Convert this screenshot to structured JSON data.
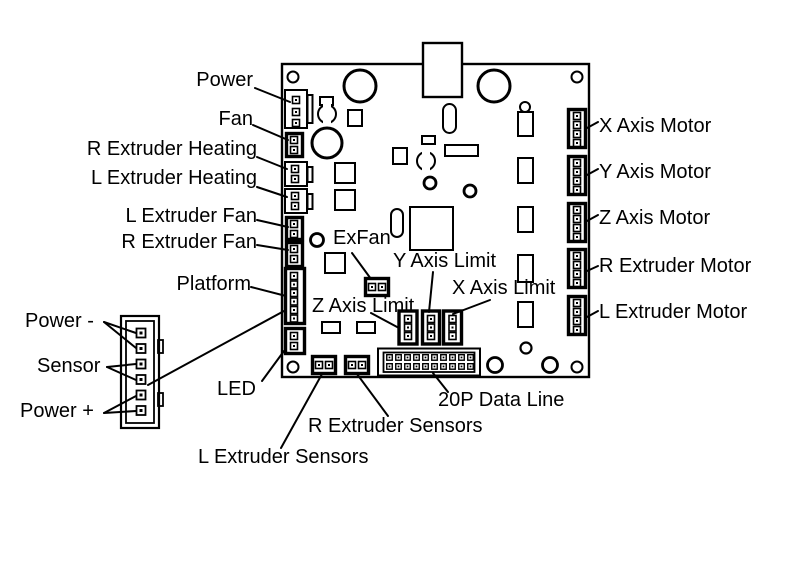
{
  "diagram": {
    "background_color": "#ffffff",
    "line_color": "#000000",
    "board": {
      "left_labels": {
        "power": "Power",
        "fan": "Fan",
        "r_extruder_heating": "R Extruder Heating",
        "l_extruder_heating": "L Extruder Heating",
        "l_extruder_fan": "L Extruder Fan",
        "r_extruder_fan": "R Extruder Fan",
        "platform": "Platform",
        "led": "LED"
      },
      "center_labels": {
        "exfan": "ExFan",
        "y_axis_limit": "Y Axis Limit",
        "x_axis_limit": "X Axis Limit",
        "z_axis_limit": "Z Axis Limit"
      },
      "bottom_labels": {
        "l_extruder_sensors": "L Extruder Sensors",
        "r_extruder_sensors": "R Extruder Sensors",
        "data_line": "20P Data Line"
      },
      "right_labels": {
        "x_axis_motor": "X Axis Motor",
        "y_axis_motor": "Y Axis Motor",
        "z_axis_motor": "Z Axis Motor",
        "r_extruder_motor": "R Extruder Motor",
        "l_extruder_motor": "L Extruder Motor"
      }
    },
    "platform_plug_labels": {
      "power_minus": "Power -",
      "sensor": "Sensor",
      "power_plus": "Power +"
    },
    "connectors": [
      {
        "name": "Power",
        "pins": 3
      },
      {
        "name": "Fan",
        "pins": 2
      },
      {
        "name": "R Extruder Heating",
        "pins": 2
      },
      {
        "name": "L Extruder Heating",
        "pins": 2
      },
      {
        "name": "L Extruder Fan",
        "pins": 2
      },
      {
        "name": "R Extruder Fan",
        "pins": 2
      },
      {
        "name": "Platform",
        "pins": 6
      },
      {
        "name": "LED",
        "pins": 2
      },
      {
        "name": "L Extruder Sensors",
        "pins": 2
      },
      {
        "name": "R Extruder Sensors",
        "pins": 2
      },
      {
        "name": "20P Data Line",
        "pins": 20
      },
      {
        "name": "ExFan",
        "pins": 2
      },
      {
        "name": "Z Axis Limit",
        "pins": 3
      },
      {
        "name": "Y Axis Limit",
        "pins": 3
      },
      {
        "name": "X Axis Limit",
        "pins": 3
      },
      {
        "name": "X Axis Motor",
        "pins": 4
      },
      {
        "name": "Y Axis Motor",
        "pins": 4
      },
      {
        "name": "Z Axis Motor",
        "pins": 4
      },
      {
        "name": "R Extruder Motor",
        "pins": 4
      },
      {
        "name": "L Extruder Motor",
        "pins": 4
      },
      {
        "name": "Platform Plug",
        "pins": 6
      }
    ]
  }
}
